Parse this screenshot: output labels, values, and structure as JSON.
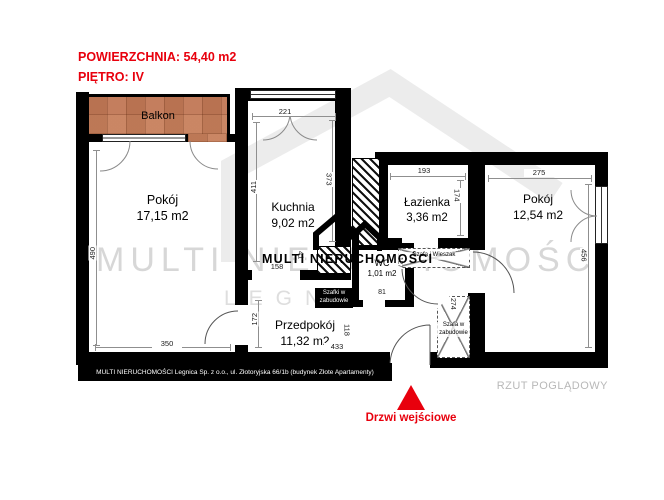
{
  "header": {
    "area_line": "POWIERZCHNIA: 54,40 m2",
    "floor_line": "PIĘTRO: IV"
  },
  "rooms": {
    "balcony": {
      "name": "Balkon"
    },
    "room_left": {
      "name": "Pokój",
      "area": "17,15 m2"
    },
    "kitchen": {
      "name": "Kuchnia",
      "area": "9,02 m2"
    },
    "bathroom": {
      "name": "Łazienka",
      "area": "3,36 m2"
    },
    "room_right": {
      "name": "Pokój",
      "area": "12,54 m2"
    },
    "wc": {
      "name": "WC",
      "area": "1,01 m2"
    },
    "hallway": {
      "name": "Przedpokój",
      "area": "11,32 m2"
    }
  },
  "dims": {
    "kitchen_width": "221",
    "kitchen_height_left": "411",
    "kitchen_height_right": "373",
    "room_left_height": "490",
    "room_left_width": "350",
    "bathroom_width": "193",
    "bathroom_height": "174",
    "room_right_width": "275",
    "room_right_height": "456",
    "kitchen_opening_width": "158",
    "kitchen_opening_depth": "41",
    "wc_width": "81",
    "wc_height": "127",
    "hallway_height_left": "172",
    "hallway_width": "433",
    "hallway_height_right": "118",
    "wardrobe_height": "274"
  },
  "features": {
    "built_in_cabinets": "Szafki w zabudowie",
    "wardrobe_hanger": "Szafa i Wieszak",
    "built_in_wardrobe": "Szafa w zabudowie"
  },
  "brand": {
    "watermark_line1": "MULTI NIERUCHOMOŚCI",
    "watermark_line2": "LEGNICA",
    "logo_text": "MULTI NIERUCHOMOŚCI"
  },
  "footer": {
    "company": "MULTI NIERUCHOMOŚCI Legnica Sp. z o.o., ul. Złotoryjska 66/1b (budynek Złote Apartamenty)",
    "view_type": "RZUT POGLĄDOWY"
  },
  "entrance": {
    "label": "Drzwi wejściowe"
  },
  "colors": {
    "accent_red": "#e8000d",
    "wall_black": "#000000",
    "balcony_terracotta": "#c47e5e",
    "watermark_gray": "#d7d7d7",
    "footer_text_gray": "#b8b8b8"
  }
}
